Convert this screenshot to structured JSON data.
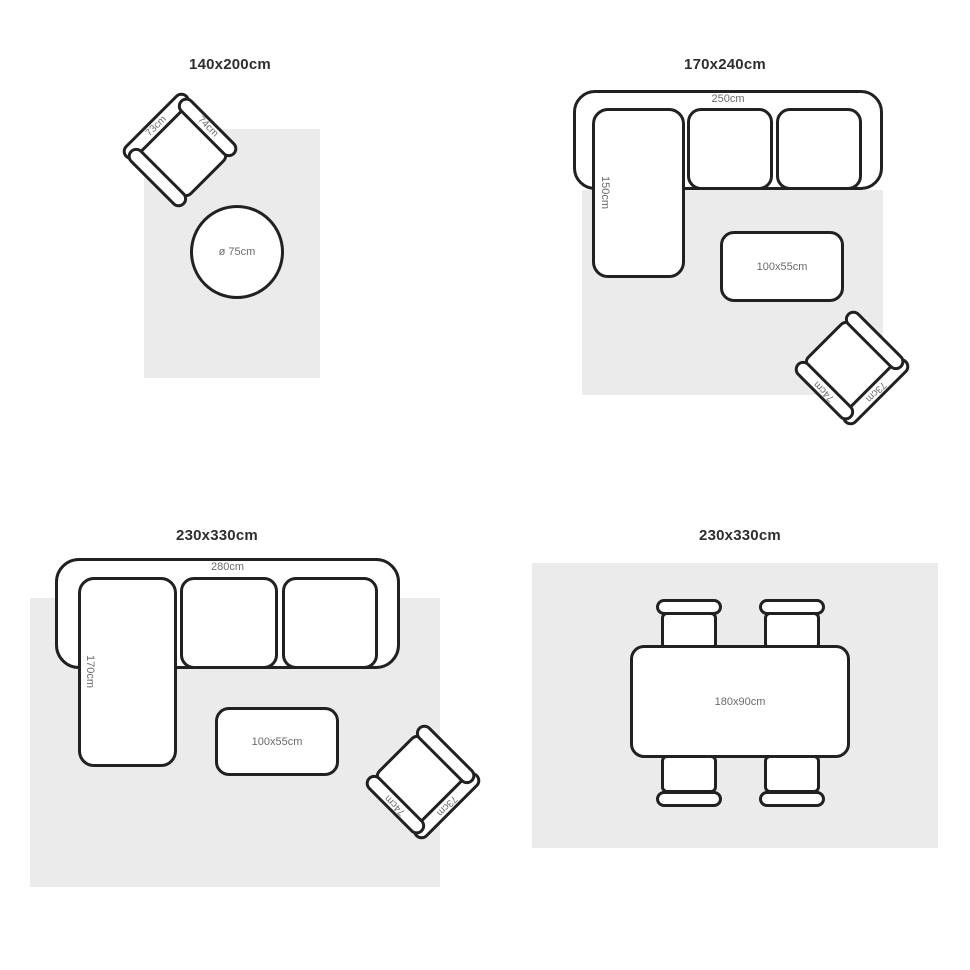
{
  "colors": {
    "background": "#ffffff",
    "rug_fill": "#ebebeb",
    "outline": "#212121",
    "dimension_label": "#6b6b6b",
    "title": "#2e2e2e"
  },
  "panels": {
    "rug_140x200": {
      "title": "140x200cm",
      "armchair": {
        "back_width": "73cm",
        "side_depth": "74cm"
      },
      "round_table": {
        "diameter": "ø 75cm"
      }
    },
    "rug_170x240": {
      "title": "170x240cm",
      "sofa": {
        "width": "250cm",
        "chaise_depth": "150cm"
      },
      "coffee_table": {
        "size": "100x55cm"
      },
      "armchair": {
        "back_width": "73cm",
        "side_depth": "74cm"
      }
    },
    "rug_230x330_living": {
      "title": "230x330cm",
      "sofa": {
        "width": "280cm",
        "chaise_depth": "170cm"
      },
      "coffee_table": {
        "size": "100x55cm"
      },
      "armchair": {
        "back_width": "73cm",
        "side_depth": "74cm"
      }
    },
    "rug_230x330_dining": {
      "title": "230x330cm",
      "dining_table": {
        "size": "180x90cm"
      }
    }
  }
}
